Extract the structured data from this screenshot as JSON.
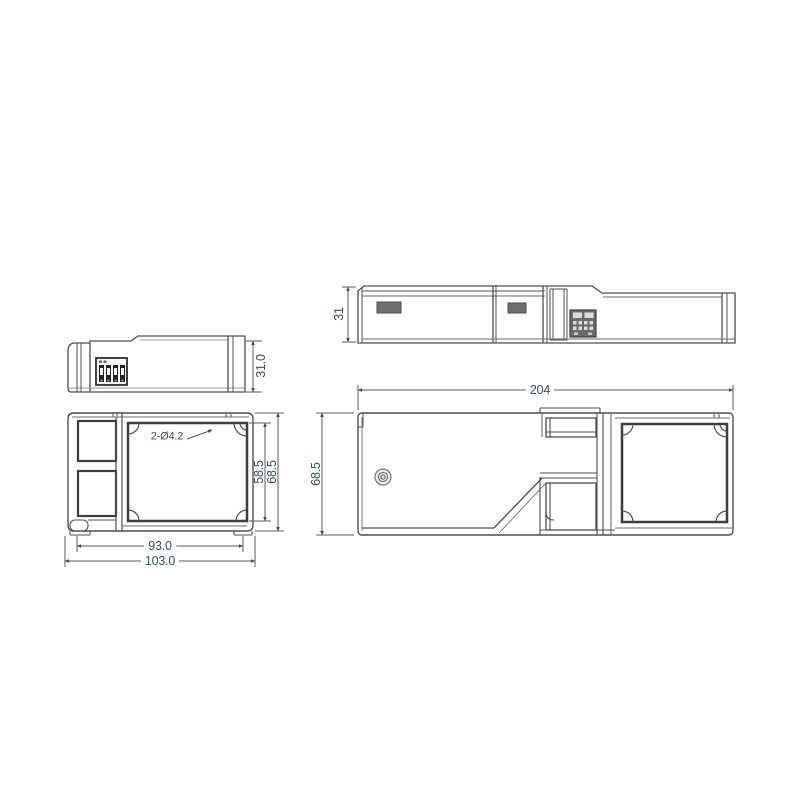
{
  "page": {
    "background": "#ffffff",
    "kind": "mechanical-dimension-drawing"
  },
  "drawing": {
    "views": {
      "side_small": {
        "height_dim": "31.0"
      },
      "side_large": {
        "height_dim": "31"
      },
      "front_small": {
        "hole_callout": "2-Ø4.2",
        "inner_height_dim": "58.5",
        "outer_height_dim": "68.5",
        "inner_width_dim": "93.0",
        "outer_width_dim": "103.0"
      },
      "front_large": {
        "length_dim": "204",
        "outer_height_dim": "68.5"
      }
    },
    "colors": {
      "line": "#4f4f4f",
      "thick_line": "#3d3d3d",
      "dim_line": "#5a5a5a",
      "dim_text": "#374f66",
      "vent_fill": "#6f6f6f",
      "connector_fill": "#6a6a6a"
    }
  }
}
